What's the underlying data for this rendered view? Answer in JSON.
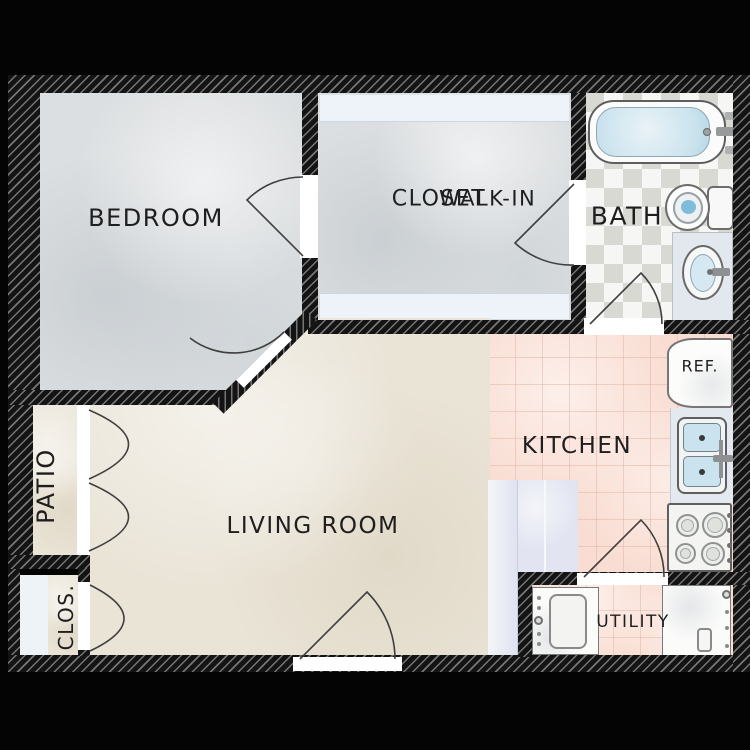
{
  "rooms": {
    "bedroom": {
      "label": "BEDROOM"
    },
    "walk_in_closet": {
      "label_line1": "WALK-IN",
      "label_line2": "CLOSET"
    },
    "bath": {
      "label": "BATH"
    },
    "kitchen": {
      "label": "KITCHEN"
    },
    "living_room": {
      "label": "LIVING ROOM"
    },
    "patio": {
      "label": "PATIO"
    },
    "closet": {
      "label": "CLOS."
    },
    "utility": {
      "label": "UTILITY"
    }
  },
  "fixtures": {
    "refrigerator": {
      "label": "REF."
    }
  },
  "palette": {
    "canvas_background": "#040404",
    "wall_black": "#141414",
    "wall_hatch_line": "#d8d8d8",
    "bedroom_closet_floor": "#dcdfe1",
    "living_patio_floor": "#eae4d7",
    "kitchen_utility_tile": "#f9ddd2",
    "bath_tile_light": "#f6f7f4",
    "bath_tile_dark": "#d8d9d3",
    "water_blue": "#cbe3ee",
    "counter_lavender": "#e2e5f1",
    "fixture_white": "#fbfbfa",
    "label_text": "#1e1e1e"
  }
}
